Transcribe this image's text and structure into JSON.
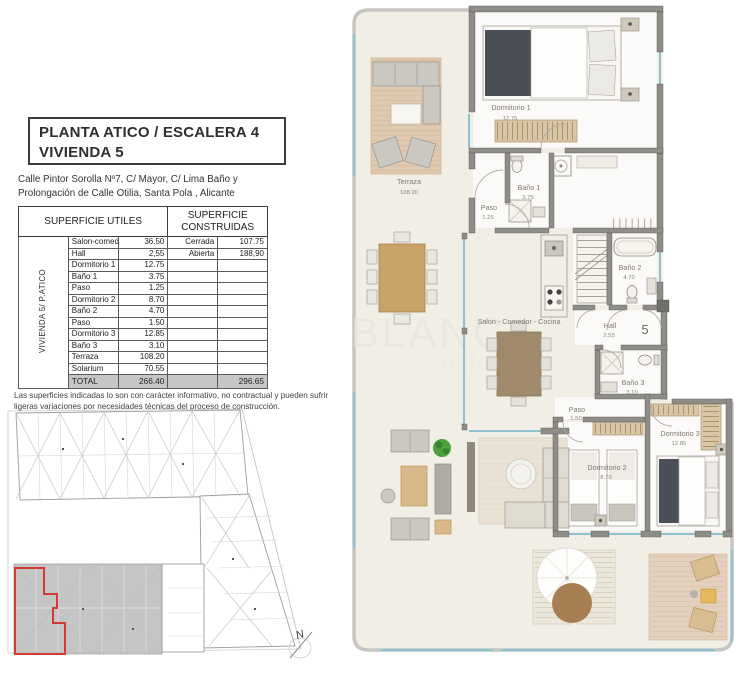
{
  "header": {
    "title_line1": "PLANTA ATICO / ESCALERA 4",
    "title_line2": "VIVIENDA 5",
    "address_line1": "Calle Pintor Sorolla Nº7, C/ Mayor, C/ Lima Baño y",
    "address_line2": "Prolongación de Calle Otilia, Santa Pola , Alicante"
  },
  "table": {
    "side_label": "VIVIENDA 5/ P.ATICO",
    "header_utiles": "SUPERFICIE UTILES",
    "header_construidas": "SUPERFICIE CONSTRUIDAS",
    "rows": [
      {
        "name": "Salon-comedor-cocina",
        "value": "36.50",
        "clabel": "Cerrada",
        "cvalue": "107.75"
      },
      {
        "name": "Hall",
        "value": "2,55",
        "clabel": "Abierta",
        "cvalue": "188,90"
      },
      {
        "name": "Dormitorio 1",
        "value": "12.75",
        "clabel": "",
        "cvalue": ""
      },
      {
        "name": "Baño 1",
        "value": "3.75",
        "clabel": "",
        "cvalue": ""
      },
      {
        "name": "Paso",
        "value": "1.25",
        "clabel": "",
        "cvalue": ""
      },
      {
        "name": "Dormitorio 2",
        "value": "8.70",
        "clabel": "",
        "cvalue": ""
      },
      {
        "name": "Baño 2",
        "value": "4.70",
        "clabel": "",
        "cvalue": ""
      },
      {
        "name": "Paso",
        "value": "1.50",
        "clabel": "",
        "cvalue": ""
      },
      {
        "name": "Dormitorio 3",
        "value": "12.85",
        "clabel": "",
        "cvalue": ""
      },
      {
        "name": "Baño 3",
        "value": "3.10",
        "clabel": "",
        "cvalue": ""
      },
      {
        "name": "Terraza",
        "value": "108.20",
        "clabel": "",
        "cvalue": ""
      },
      {
        "name": "Solarium",
        "value": "70.55",
        "clabel": "",
        "cvalue": ""
      }
    ],
    "total": {
      "label": "TOTAL",
      "utiles": "266.40",
      "construidas": "296.65"
    }
  },
  "disclaimer": {
    "line1": "Las superficies indicadas lo son con carácter informativo, no contractual y pueden sufrir",
    "line2": "ligeras variaciones por necesidades técnicas del proceso de construcción."
  },
  "site_plan": {
    "north_label": "N"
  },
  "plan": {
    "watermark_line1": "BLANCA",
    "watermark_line2": "estate",
    "unit_number": "5",
    "rooms": [
      {
        "name": "Terraza",
        "area": "108.20"
      },
      {
        "name": "Dormitorio 1",
        "area": "12.75"
      },
      {
        "name": "Paso",
        "area": "1.25"
      },
      {
        "name": "Baño 1",
        "area": "3.75"
      },
      {
        "name": "Baño 2",
        "area": "4.70"
      },
      {
        "name": "Salon - Comedor - Cocina",
        "area": "36.50"
      },
      {
        "name": "Hall",
        "area": "2.55"
      },
      {
        "name": "Baño 3",
        "area": "3.10"
      },
      {
        "name": "Paso",
        "area": "1.50"
      },
      {
        "name": "Dormitorio 2",
        "area": "8.70"
      },
      {
        "name": "Dormitorio 3",
        "area": "12.85"
      }
    ]
  }
}
